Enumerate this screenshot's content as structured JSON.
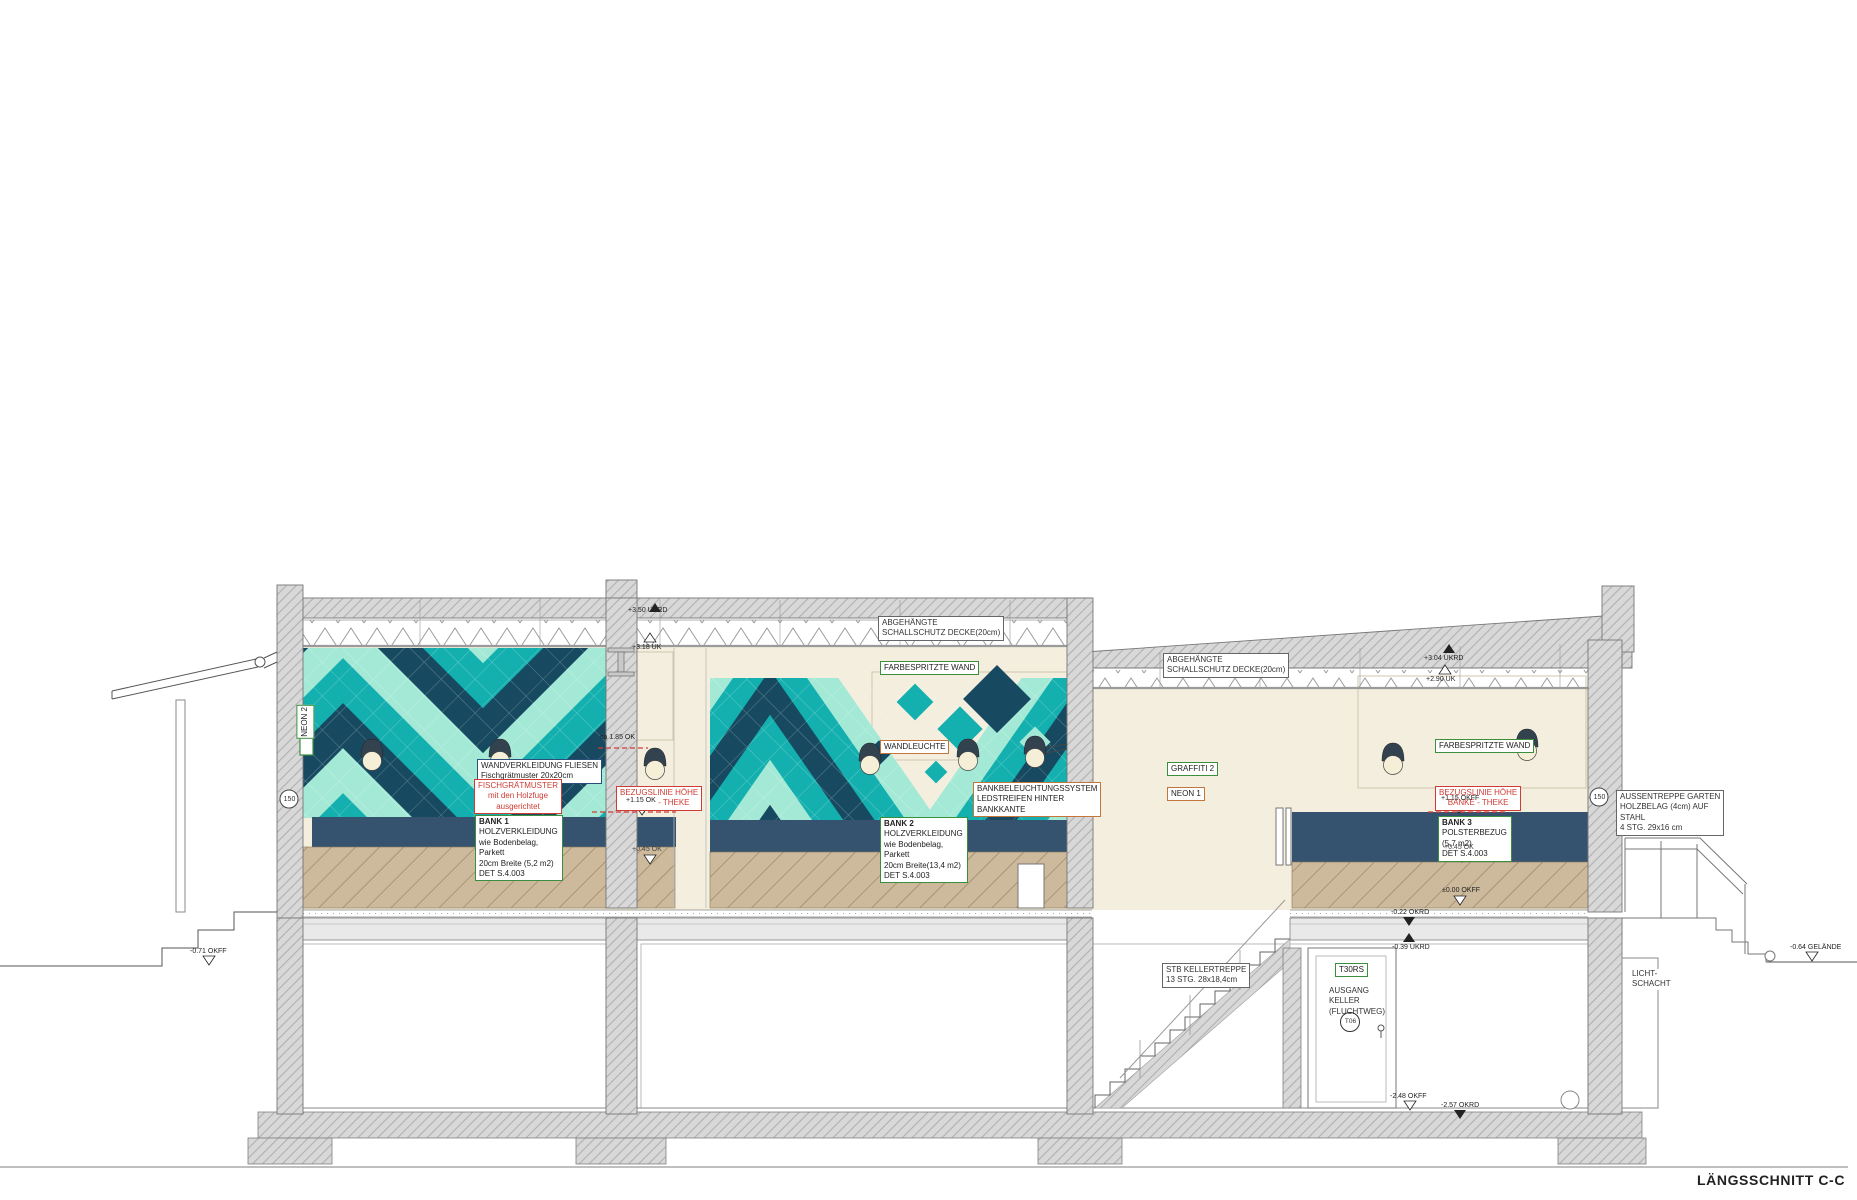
{
  "drawing": {
    "title": "LÄNGSSCHNITT C-C",
    "colors": {
      "tile_navy": "#174a61",
      "tile_teal": "#14b0af",
      "tile_mint": "#a3e9d6",
      "wall_cream": "#f3eedd",
      "bench_navy": "#35536e",
      "concrete_gray": "#d8d8d8",
      "wood_beige": "#cdb99c",
      "label_green": "#3a8f3f",
      "label_red": "#d03b35",
      "label_blue": "#2a4f7a",
      "label_orange": "#c4763a"
    },
    "annotations": {
      "neon2": "NEON 2",
      "wall_tiles": "WANDVERKLEIDUNG FLIESEN\nFischgrätmuster 20x20cm",
      "herringbone": "FISCHGRÄTMUSTER\nmit den Holzfuge\nausgerichtet",
      "bank1": "BANK 1\nHOLZVERKLEIDUNG\nwie Bodenbelag,\nParkett\n20cm Breite (5,2 m2)\nDET S.4.003",
      "reference_line_left": "BEZUGSLINIE HÖHE\nBÄNKE - THEKE",
      "ceiling_left": "ABGEHÄNGTE\nSCHALLSCHUTZ DECKE(20cm)",
      "painted_wall_mid": "FARBESPRITZTE WAND",
      "wall_lamp": "WANDLEUCHTE",
      "bench_lighting": "BANKBELEUCHTUNGSSYSTEM\nLEDSTREIFEN HINTER\nBANKKANTE",
      "bank2": "BANK 2\nHOLZVERKLEIDUNG\nwie Bodenbelag,\nParkett\n20cm Breite(13,4 m2)\nDET S.4.003",
      "ceiling_right": "ABGEHÄNGTE\nSCHALLSCHUTZ DECKE(20cm)",
      "graffiti2": "GRAFFITI 2",
      "neon1": "NEON 1",
      "painted_wall_right": "FARBESPRITZTE WAND",
      "reference_line_right": "BEZUGSLINIE HÖHE\nBÄNKE - THEKE",
      "bank3": "BANK 3\nPOLSTERBEZUG\n(5,7 m2)\nDET S.4.003",
      "basement_stair": "STB KELLERTREPPE\n13 STG. 28x18,4cm",
      "door_type": "T30RS",
      "exit": "AUSGANG\nKELLER\n(FLUCHTWEG)",
      "door_tag": "T06",
      "garden_stair": "AUSSENTREPPE GARTEN\nHOLZBELAG (4cm) AUF\nSTAHL\n4 STG. 29x16 cm",
      "light_shaft": "LICHT-\nSCHACHT",
      "tag150": "150"
    },
    "levels": {
      "roof_uk_left": "+3.50 UKRD",
      "ceiling_uk_left": "+3.18 UK",
      "roof_uk_right": "+3.04 UKRD",
      "ceiling_uk_right": "+2.90 UK",
      "lamp_height": "ca 1.85 OK",
      "bench_ref_left": "+1.15 OK",
      "bench_ref_right": "+1.15 OKFF",
      "seat_left": "+0.45 OK",
      "seat_right": "+0.45 OK",
      "floor_zero": "±0.00 OKFF",
      "slab_top": "-0.22 OKRD",
      "slab_bottom": "-0.39 UKRD",
      "basement_floor": "-2.48 OKFF",
      "basement_slab": "-2.57 OKRD",
      "ground_left": "-0.71 OKFF",
      "ground_right": "-0.64 GELÄNDE"
    }
  }
}
